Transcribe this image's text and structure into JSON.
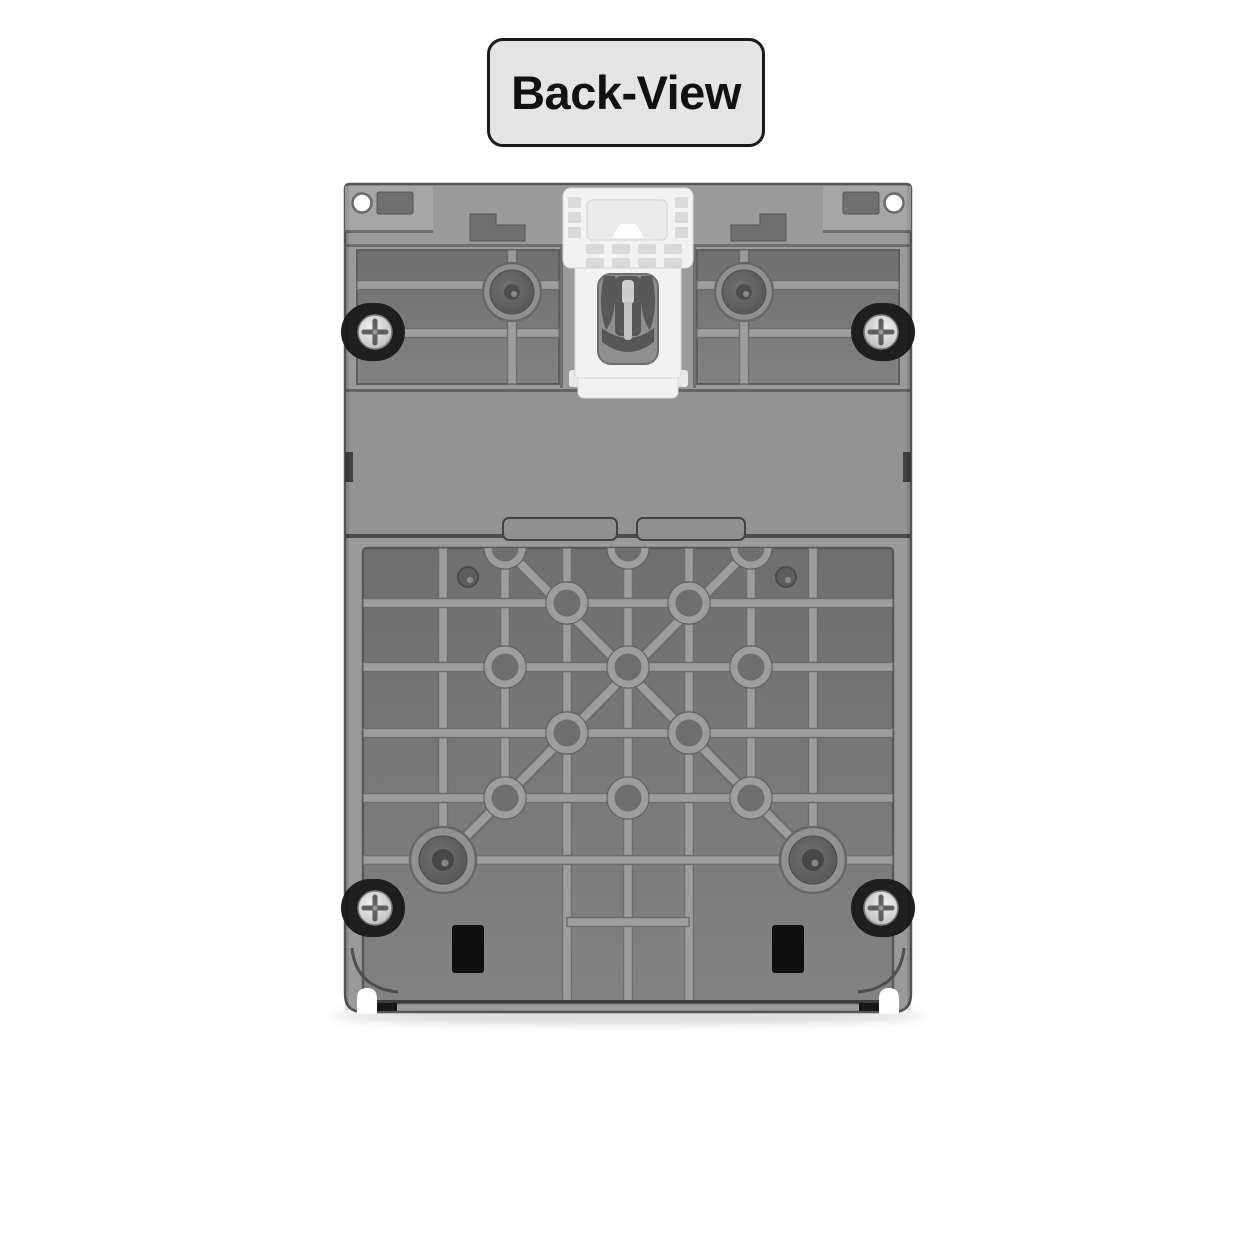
{
  "view_label": {
    "text": "Back-View"
  },
  "colors": {
    "page_bg": "#ffffff",
    "label_bg": "#e4e4e4",
    "label_border": "#1a1a1a",
    "label_text": "#111111",
    "body_gray": "#9a9a9a",
    "panel_recess_dark": "#6f6f6f",
    "panel_recess_light": "#828282",
    "rib_gray": "#9d9d9d",
    "rib_edge": "#6e6e6e",
    "band_gray": "#939393",
    "clip_white": "#f2f2f2",
    "clip_detail": "#d8d8d8",
    "screw_recess": "#1f1f1f",
    "screw_silver": "#f0f0f0",
    "vent_black": "#0f0f0f",
    "hole_white": "#ffffff",
    "outline_dark": "#565656"
  },
  "device": {
    "name": "device-back-panel",
    "parts": [
      "mounting-tab-top-left",
      "mounting-tab-top-right",
      "mounting-hole-top-left",
      "mounting-hole-top-right",
      "din-rail-clip",
      "din-clip-spring-fork",
      "ribbed-panel-top-left",
      "ribbed-panel-top-right",
      "screw-top-left",
      "screw-top-right",
      "screw-bottom-left",
      "screw-bottom-right",
      "boss-top-left",
      "boss-top-right",
      "boss-bottom-left",
      "boss-bottom-right",
      "mid-band",
      "rib-grid",
      "diagonal-ribs",
      "vent-slot-bottom-left",
      "vent-slot-bottom-right",
      "bottom-notch-left",
      "bottom-notch-right"
    ]
  }
}
